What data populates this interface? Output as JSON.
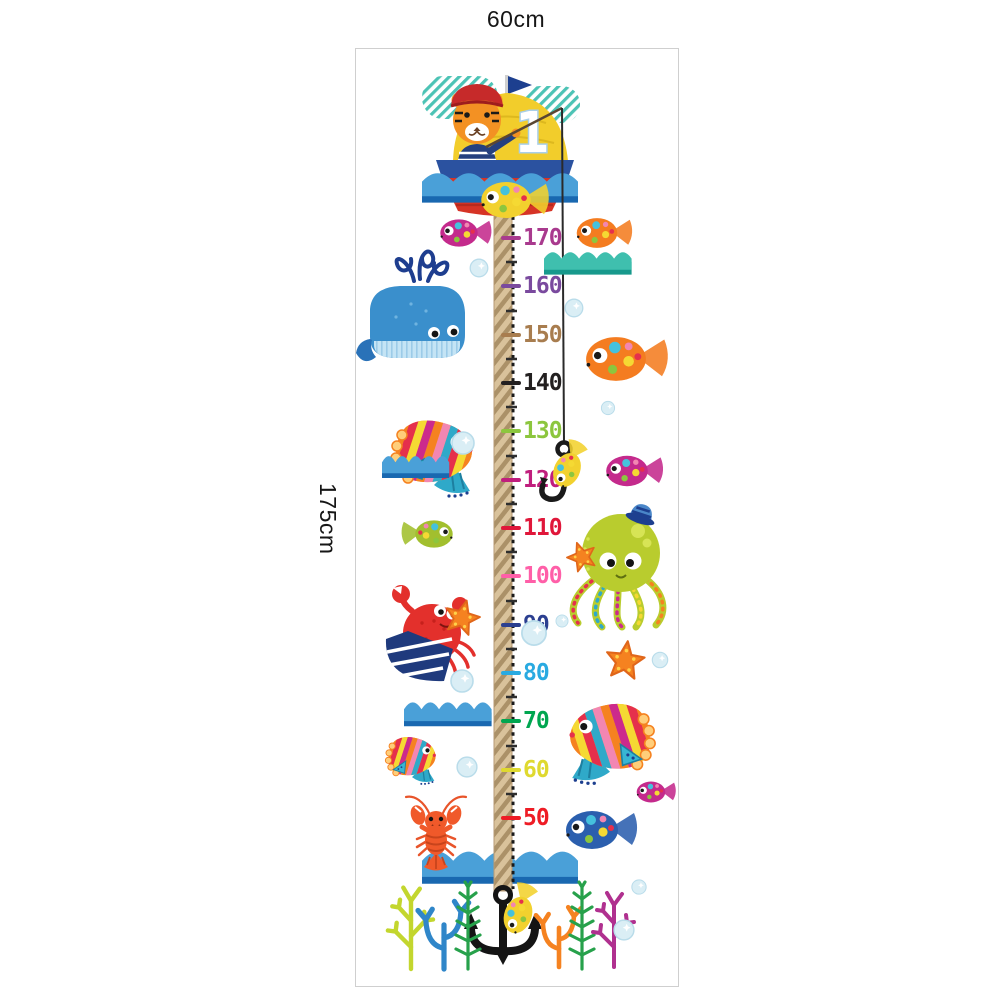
{
  "dimensions": {
    "width_label": "60cm",
    "height_label": "175cm"
  },
  "sticker": {
    "border_color": "#cfcfcf",
    "sail_number": "1",
    "ruler": {
      "rope_color": "#d9c29b",
      "marks": [
        {
          "value": "170",
          "color": "#a93a8e"
        },
        {
          "value": "160",
          "color": "#7a4a9e"
        },
        {
          "value": "150",
          "color": "#a87d4f"
        },
        {
          "value": "140",
          "color": "#232020"
        },
        {
          "value": "130",
          "color": "#8cc63e"
        },
        {
          "value": "120",
          "color": "#c01e7d"
        },
        {
          "value": "110",
          "color": "#e0173a"
        },
        {
          "value": "100",
          "color": "#ff5fa8"
        },
        {
          "value": "90",
          "color": "#2b3f90"
        },
        {
          "value": "80",
          "color": "#29aae1"
        },
        {
          "value": "70",
          "color": "#00a650"
        },
        {
          "value": "60",
          "color": "#dfd92f"
        },
        {
          "value": "50",
          "color": "#ee1c25"
        }
      ]
    },
    "palette": {
      "wave_blue": "#4aa0d8",
      "wave_blue_dark": "#1968b0",
      "wave_teal": "#3fbfae",
      "wave_teal_dark": "#17998c",
      "boat_hull_red": "#d63426",
      "boat_rim_navy": "#2b52a0",
      "sail_yellow": "#f2cd2b",
      "whale_blue": "#3a8fcc",
      "octopus_green": "#b9cc2e",
      "crab_red": "#e3302c",
      "lobster_orange": "#f0592a",
      "starfish_orange": "#f58220",
      "anchor_black": "#141414",
      "yellow_fish": "#f2d12e",
      "magenta_fish": "#c42a8c",
      "orange_fish": "#f47c20",
      "blue_fish": "#2b5fae",
      "green_fish": "#a2bf2e"
    },
    "illustrations": [
      "striped-cloud",
      "sailboat-with-tiger-sailor",
      "fishing-line-and-hook",
      "spotted-fish",
      "blue-whale",
      "tropical-striped-fish",
      "puffer-fish",
      "octopus-with-sailor-hat",
      "starfish",
      "crab",
      "lobster",
      "anchor-with-yellow-fish",
      "sea-waves",
      "coral",
      "seaweed",
      "bubbles"
    ]
  }
}
